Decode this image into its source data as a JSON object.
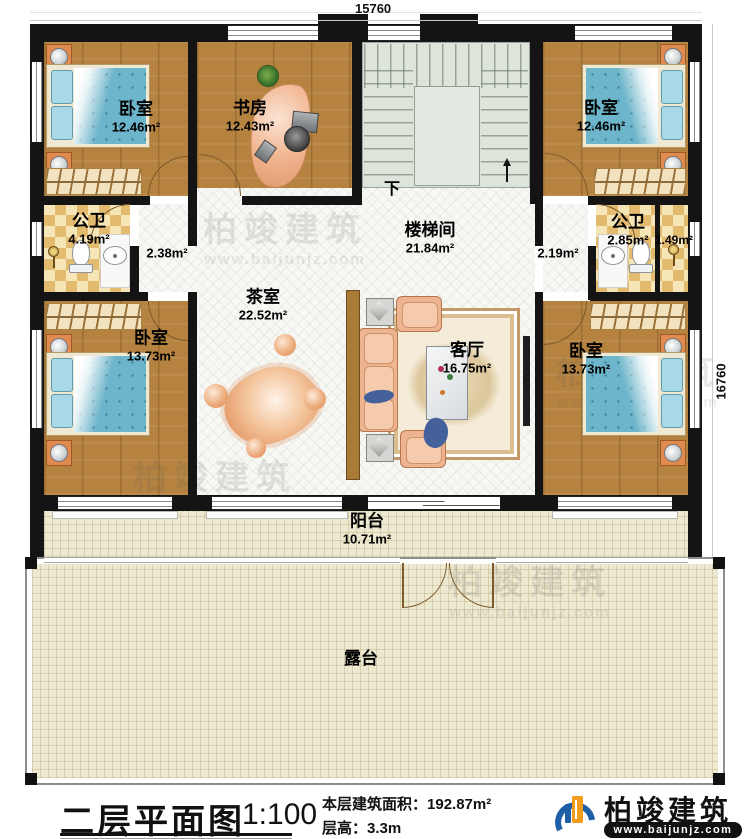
{
  "dimensions": {
    "top": "15760",
    "right": "16760"
  },
  "watermark": {
    "brand": "柏竣建筑",
    "url": "www.baijunjz.com"
  },
  "plan": {
    "stair_down": "下",
    "rooms": [
      {
        "id": "bedroom-tl",
        "name": "卧室",
        "area": "12.46m²"
      },
      {
        "id": "study",
        "name": "书房",
        "area": "12.43m²"
      },
      {
        "id": "bedroom-tr",
        "name": "卧室",
        "area": "12.46m²"
      },
      {
        "id": "bath-left",
        "name": "公卫",
        "area": "4.19m²"
      },
      {
        "id": "hall-left",
        "name": "",
        "area": "2.38m²"
      },
      {
        "id": "stairwell",
        "name": "楼梯间",
        "area": "21.84m²"
      },
      {
        "id": "hall-right",
        "name": "",
        "area": "2.19m²"
      },
      {
        "id": "bath-right",
        "name": "公卫",
        "area": "2.85m²"
      },
      {
        "id": "shower-right",
        "name": "",
        "area": "1.49m²"
      },
      {
        "id": "bedroom-bl",
        "name": "卧室",
        "area": "13.73m²"
      },
      {
        "id": "tea-room",
        "name": "茶室",
        "area": "22.52m²"
      },
      {
        "id": "living-room",
        "name": "客厅",
        "area": "16.75m²"
      },
      {
        "id": "bedroom-br",
        "name": "卧室",
        "area": "13.73m²"
      },
      {
        "id": "balcony",
        "name": "阳台",
        "area": "10.71m²"
      },
      {
        "id": "terrace",
        "name": "露台",
        "area": ""
      }
    ]
  },
  "footer": {
    "title": "二层平面图",
    "scale": "1:100",
    "floor_area_label": "本层建筑面积：",
    "floor_area_value": "192.87m²",
    "floor_height_label": "层高：",
    "floor_height_value": "3.3m",
    "brand": "柏竣建筑",
    "brand_url": "www.baijunjz.com"
  }
}
